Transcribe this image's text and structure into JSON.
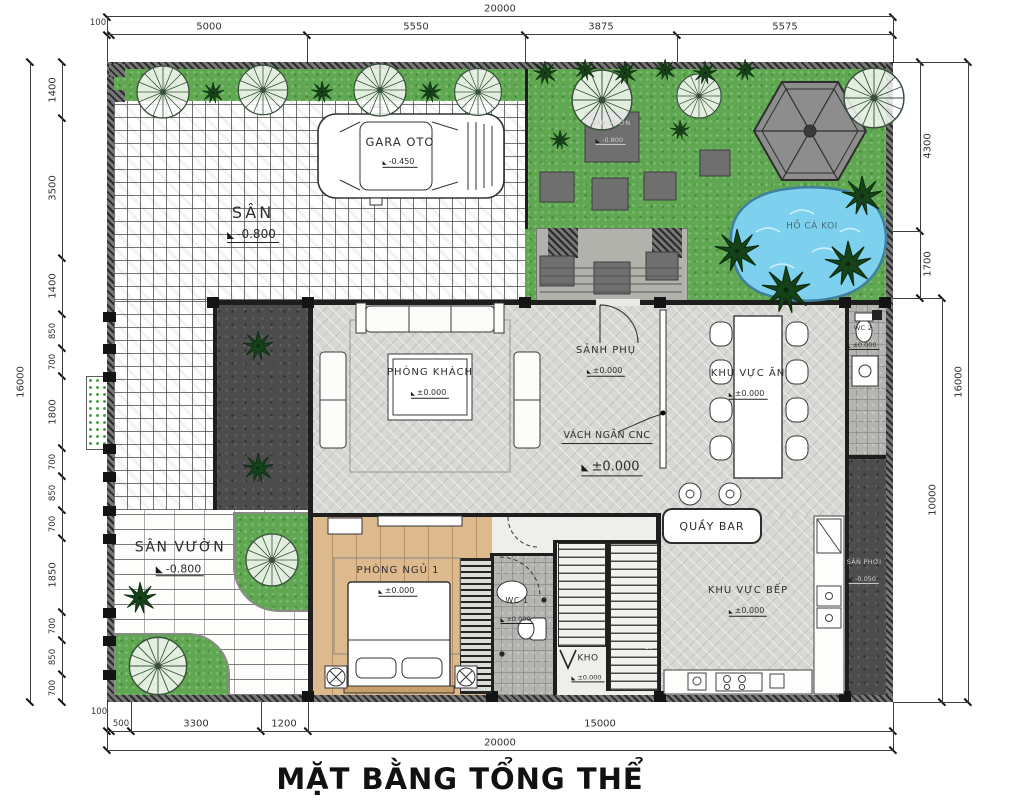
{
  "title": "MẶT BẰNG TỔNG THỂ",
  "dims": {
    "top_total": "20000",
    "top": [
      "100",
      "5000",
      "5550",
      "3875",
      "5575"
    ],
    "left_total": "16000",
    "left": [
      "1400",
      "3500",
      "1400",
      "850",
      "700",
      "1800",
      "700",
      "850",
      "700",
      "1850",
      "700",
      "850",
      "700"
    ],
    "right": [
      "4300",
      "1700"
    ],
    "right_inner_total": "10000",
    "right_total": "16000",
    "bottom": [
      "100",
      "500",
      "3300",
      "1200",
      "15000"
    ],
    "bottom_total": "20000"
  },
  "rooms": {
    "san": {
      "label": "SÂN",
      "elev": "-0.800"
    },
    "gara": {
      "label": "GARA OTO",
      "elev": "-0.450"
    },
    "garden_pad": {
      "label": "SÂN VƯỜN",
      "elev": "-0.800"
    },
    "koi": {
      "label": "HỒ CÁ KOI"
    },
    "phong_khach": {
      "label": "PHÒNG KHÁCH",
      "elev": "±0.000"
    },
    "sanh_phu": {
      "label": "SẢNH PHỤ",
      "elev": "±0.000"
    },
    "khu_vuc_an": {
      "label": "KHU VỰC ĂN",
      "elev": "±0.000"
    },
    "vach_ngan": {
      "label": "VÁCH NGĂN CNC"
    },
    "hall": {
      "elev": "±0.000"
    },
    "wc2": {
      "label": "WC 2",
      "elev": "±0.000"
    },
    "quay_bar": {
      "label": "QUẦY BAR"
    },
    "khu_vuc_bep": {
      "label": "KHU VỰC BẾP",
      "elev": "±0.000"
    },
    "san_phoi": {
      "label": "SÂN PHƠI",
      "elev": "-0.050"
    },
    "phong_ngu1": {
      "label": "PHÒNG NGỦ 1",
      "elev": "±0.000"
    },
    "wc1": {
      "label": "WC 1",
      "elev": "±0.000"
    },
    "kho": {
      "label": "KHO",
      "elev": "±0.000"
    },
    "san_vuon": {
      "label": "SÂN VƯỜN",
      "elev": "-0.800"
    },
    "stair_steps": "10"
  }
}
